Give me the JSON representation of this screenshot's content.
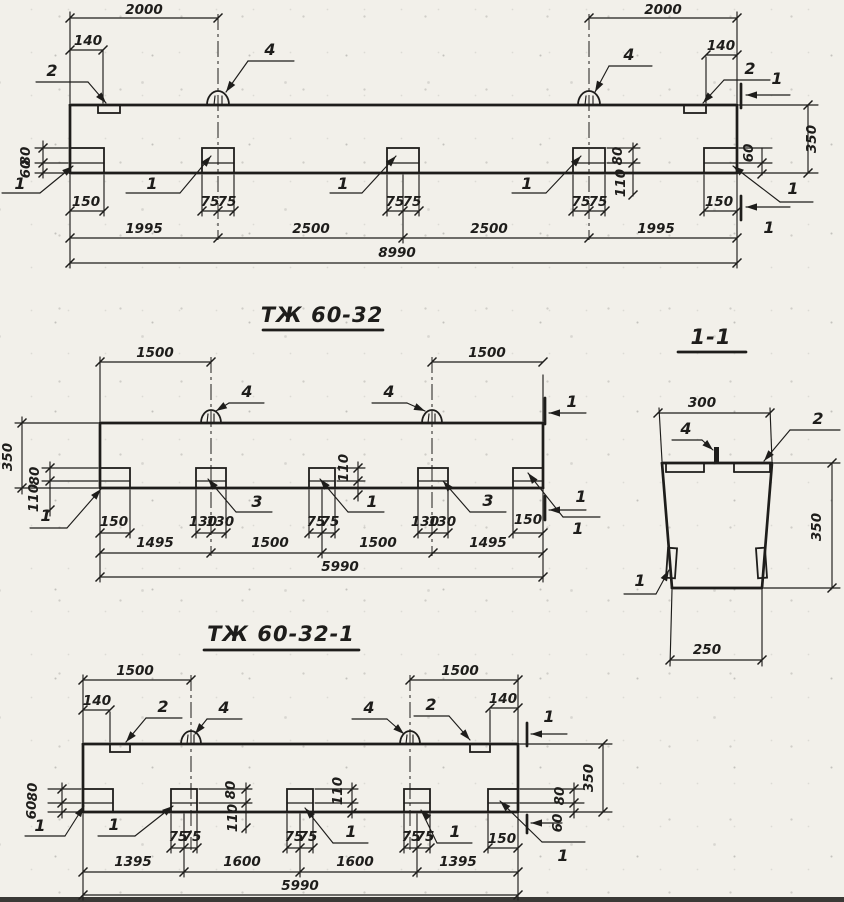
{
  "page": {
    "background": "#f2f0ea",
    "ink": "#1e1d1b"
  },
  "callouts": {
    "n1": "1",
    "n2": "2",
    "n3": "3",
    "n4": "4"
  },
  "top_view": {
    "dim_span_left": "2000",
    "dim_span_right": "2000",
    "dim_plate_offset_left": "140",
    "dim_plate_offset_right": "140",
    "dim_height": "350",
    "dim_h80": "80",
    "dim_h60": "60",
    "dim_h110": "110",
    "dim_end_stud": "150",
    "dim_end_stud_right": "150",
    "dim_stud_half": "75",
    "chain": [
      "1995",
      "2500",
      "2500",
      "1995"
    ],
    "dim_total": "8990"
  },
  "middle_view": {
    "title": "ТЖ 60-32",
    "dim_span_left": "1500",
    "dim_span_right": "1500",
    "dim_height": "350",
    "dim_h80": "80",
    "dim_h110": "110",
    "dim_end_stud": "150",
    "dim_end_stud_right": "150",
    "dim_stud_half_130": "130",
    "dim_stud_half_75": "75",
    "chain": [
      "1495",
      "1500",
      "1500",
      "1495"
    ],
    "dim_total": "5990"
  },
  "section_view": {
    "title": "1-1",
    "dim_width_top": "300",
    "dim_height": "350",
    "dim_width_bottom": "250"
  },
  "bottom_view": {
    "title": "ТЖ 60-32-1",
    "dim_span_left": "1500",
    "dim_span_right": "1500",
    "dim_plate_offset_left": "140",
    "dim_plate_offset_right": "140",
    "dim_height": "350",
    "dim_h80": "80",
    "dim_h60": "60",
    "dim_h110": "110",
    "dim_end_stud": "150",
    "dim_stud_half": "75",
    "chain": [
      "1395",
      "1600",
      "1600",
      "1395"
    ],
    "dim_total": "5990"
  }
}
